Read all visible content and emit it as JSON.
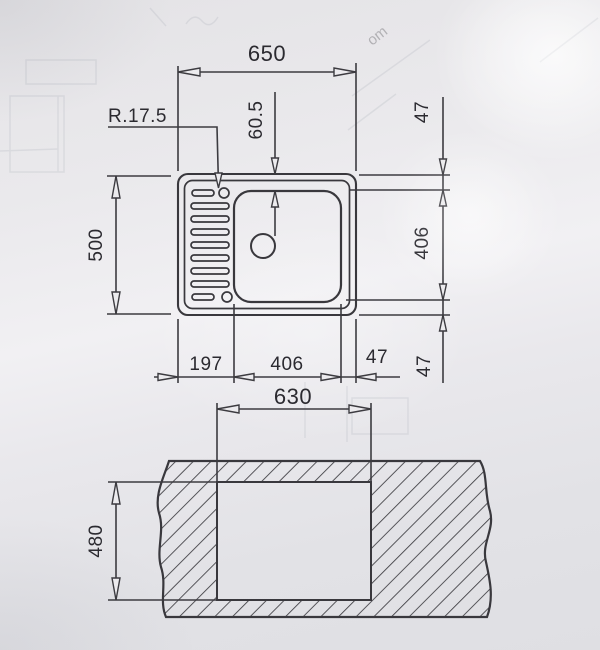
{
  "drawing": {
    "plan_view": {
      "overall_width": "650",
      "overall_depth": "500",
      "corner_radius": "R.17.5",
      "bowl_offset_top": "60.5",
      "right_top": "47",
      "right_bowl": "406",
      "right_bottom": "47",
      "bottom_drainer": "197",
      "bottom_bowl": "406",
      "bottom_edge": "47"
    },
    "cutout_view": {
      "cutout_width": "630",
      "cutout_depth": "480"
    },
    "ghost_text": "om"
  }
}
